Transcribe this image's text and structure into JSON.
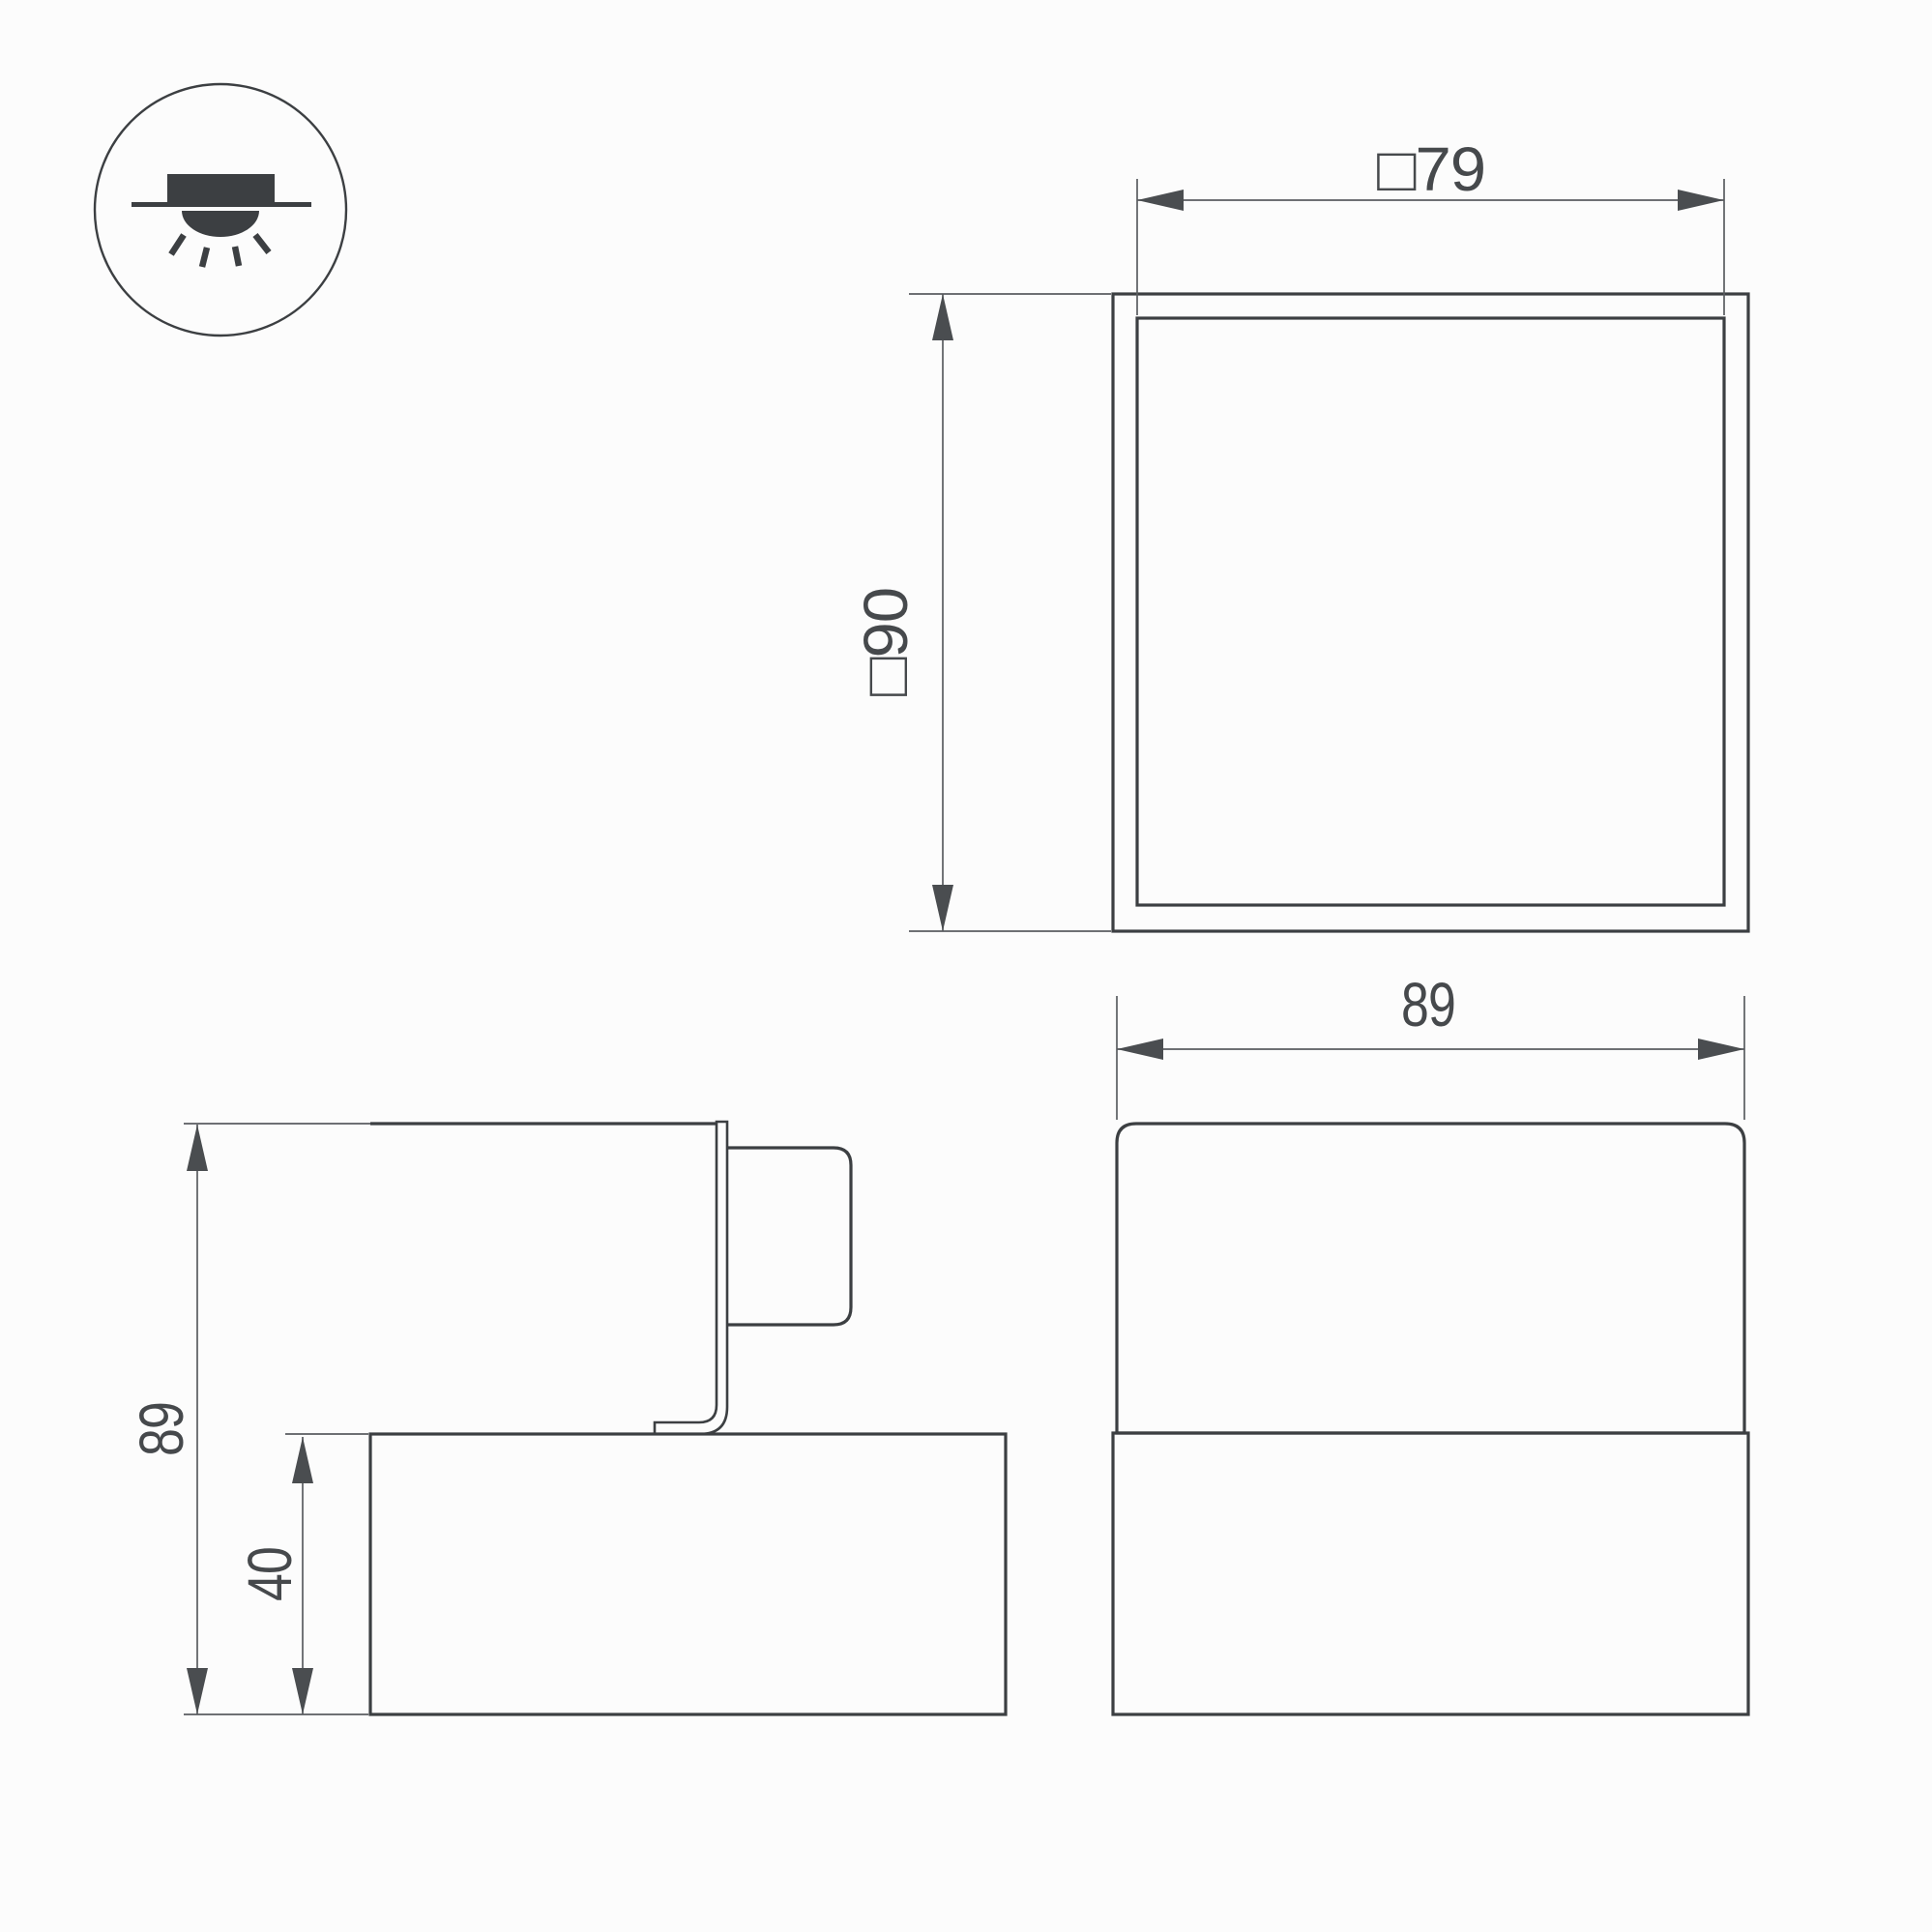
{
  "drawing": {
    "colors": {
      "background": "#fcfcfc",
      "outline": "#3c3f42",
      "dimension_line": "#5a5d60",
      "arrow": "#4a4d50",
      "text": "#46494c"
    },
    "icon": {
      "meaning": "recessed-ceiling-downlight"
    },
    "views": {
      "plan": {
        "width_label": "□79",
        "height_label": "□90"
      },
      "front": {
        "width_label": "89"
      },
      "side": {
        "height_label": "89",
        "base_height_label": "40"
      }
    }
  }
}
